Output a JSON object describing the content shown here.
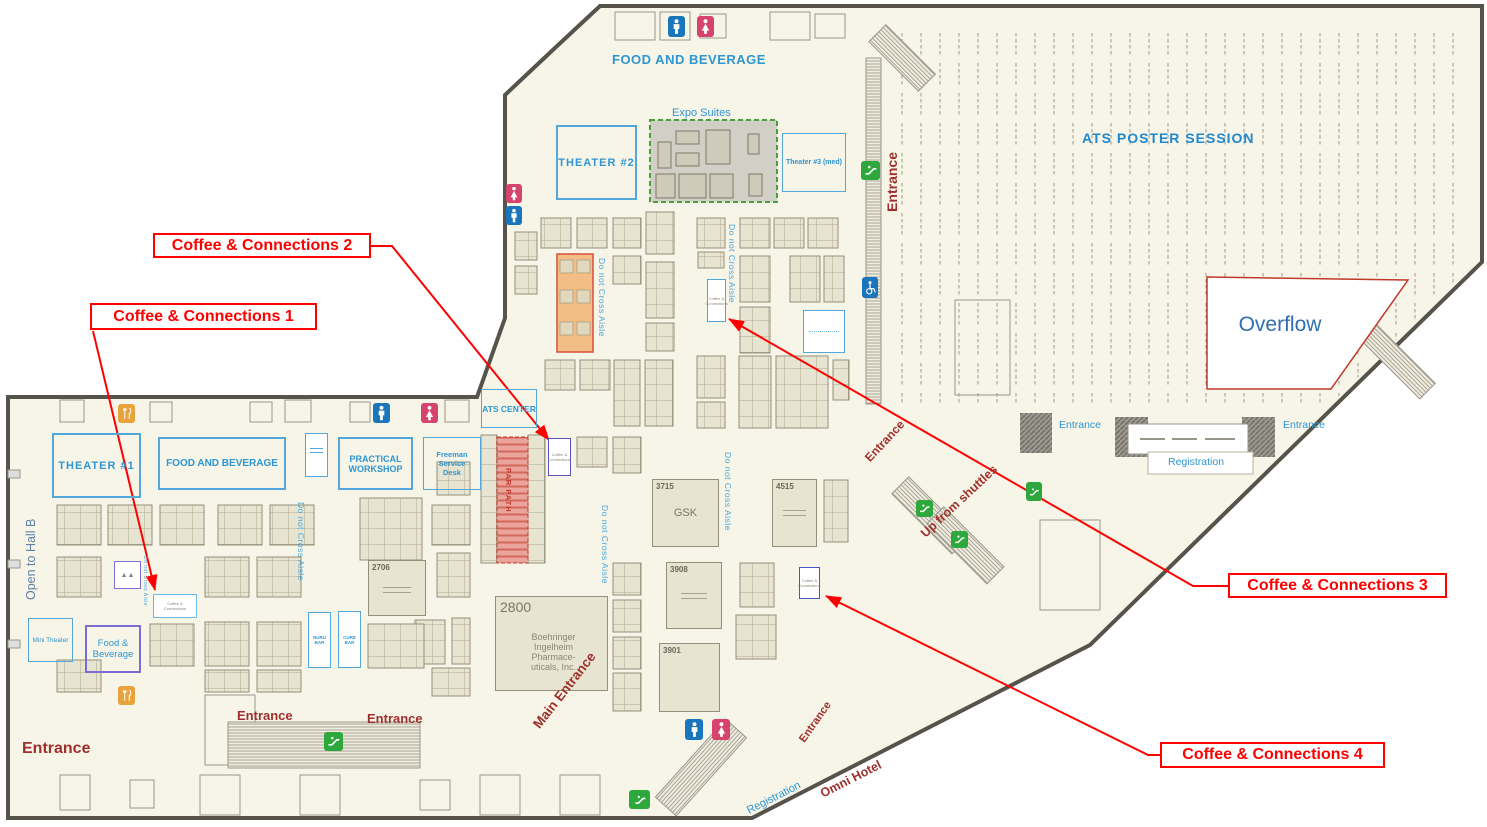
{
  "callouts": {
    "c1": "Coffee & Connections 1",
    "c2": "Coffee & Connections 2",
    "c3": "Coffee & Connections 3",
    "c4": "Coffee & Connections 4"
  },
  "areas": {
    "food_beverage_top": "FOOD AND BEVERAGE",
    "theater2": "THEATER #2",
    "expo_suites": "Expo Suites",
    "theater3": "Theater #3 (med)",
    "poster_session": "ATS POSTER SESSION",
    "overflow": "Overflow",
    "theater1": "THEATER #1",
    "food_beverage_left": "FOOD AND BEVERAGE",
    "practical_workshop": "PRACTICAL WORKSHOP",
    "freeman_desk": "Freeman Service Desk",
    "ats_center": "ATS CENTER",
    "mini_theater": "Mini Theater",
    "food_beverage_small": "Food & Beverage",
    "open_to_hall_b": "Open to Hall B",
    "nuru_bar": "NURU BAR",
    "cure_bar": "CURE BAR"
  },
  "booths": {
    "b2800_num": "2800",
    "b2800_name": "Boehringer\nIngelheim\nPharmace-\nuticals, Inc.",
    "b3715_num": "3715",
    "b3715_name": "GSK",
    "b4515_num": "4515",
    "b3908_num": "3908",
    "b3901_num": "3901",
    "b2706_num": "2706",
    "coffee_small": "Coffee &\nConnections"
  },
  "labels": {
    "entrance": "Entrance",
    "main_entrance": "Main Entrance",
    "registration": "Registration",
    "up_from_shuttles": "Up from shuttles",
    "omni_hotel": "Omni Hotel",
    "do_not_cross": "Do not Cross Aisle",
    "par_path": "PAR PATH"
  },
  "colors": {
    "floor": "#F7F4E8",
    "wall": "#56534B",
    "accent_blue": "#2E96D2",
    "callout_red": "#FF0000",
    "entrance_maroon": "#9E302C",
    "booth_beige": "#E8E4D2",
    "escalator_green": "#2EA83C",
    "restroom_blue": "#1B75BB",
    "restroom_pink": "#D6446E",
    "food_orange": "#E8A33D",
    "overflow_border": "#C0392B",
    "expo_fill": "#D2CFC6"
  }
}
